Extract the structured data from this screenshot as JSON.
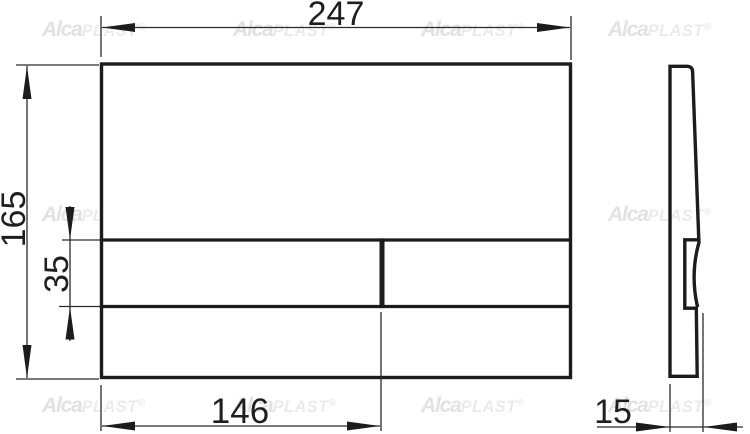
{
  "watermark": {
    "primary": "Alca",
    "secondary": "PLAST",
    "registered": "®"
  },
  "dimensions": {
    "width": {
      "label": "247"
    },
    "height": {
      "label": "165"
    },
    "panel_height": {
      "label": "35"
    },
    "button_width": {
      "label": "146"
    },
    "thickness": {
      "label": "15"
    }
  },
  "colors": {
    "line": "#1c1c1e",
    "dimension_line": "#2b2b2d",
    "label_text": "#1e1e20",
    "watermark_primary": "#e2e2e2",
    "watermark_secondary": "#ebebeb",
    "background": "#ffffff"
  }
}
